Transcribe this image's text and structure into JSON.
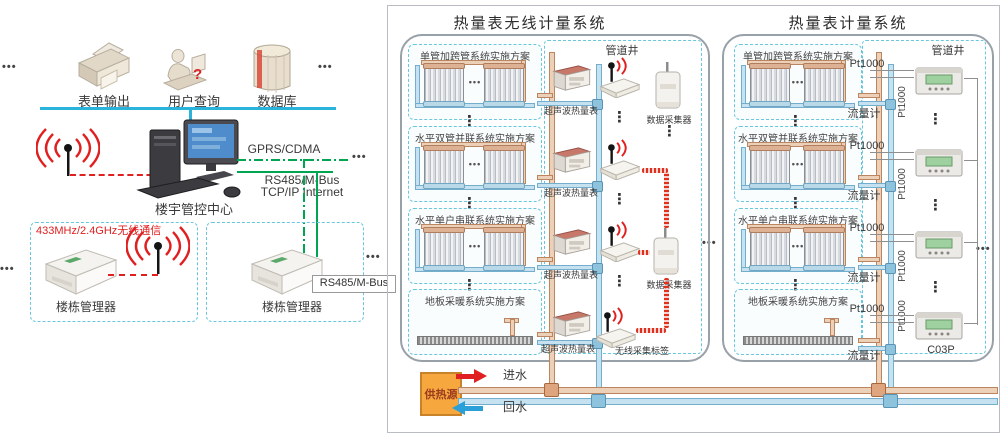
{
  "symbols": {
    "h_dots": "•••",
    "v_dots": "⋮",
    "q_mark": "?"
  },
  "colors": {
    "hot_pipe": "#ecd0b8",
    "cold_pipe": "#c6e2f0",
    "green_link": "#00a551",
    "red_wireless": "#e02020",
    "cyan_bus": "#2ab4dc",
    "source_box": "#f6a83f"
  },
  "left": {
    "icons": [
      {
        "label": "表单输出"
      },
      {
        "label": "用户查询"
      },
      {
        "label": "数据库"
      }
    ],
    "center_label": "楼宇管控中心",
    "links": {
      "gprs": "GPRS/CDMA",
      "rs485": "RS485/M-Bus",
      "tcpip": "TCP/IP Internet"
    },
    "wireless_433": "433MHz/2.4GHz无线通信",
    "manager_left": "楼栋管理器",
    "manager_right": "楼栋管理器",
    "rs485_tag": "RS485/M-Bus"
  },
  "panels": {
    "wireless": {
      "title": "热量表无线计量系统"
    },
    "wired": {
      "title": "热量表计量系统"
    }
  },
  "schemes": [
    "单管加跨管系统实施方案",
    "水平双管并联系统实施方案",
    "水平单户串联系统实施方案",
    "地板采暖系统实施方案"
  ],
  "labels": {
    "shaft": "管道井",
    "ultrasonic": "超声波热量表",
    "collector": "数据采集器",
    "wireless_tag": "无线采集标签",
    "pt": "Pt1000",
    "flow": "流量计",
    "model": "C03P"
  },
  "bottom": {
    "source": "供热源",
    "inlet": "进水",
    "return": "回水"
  }
}
